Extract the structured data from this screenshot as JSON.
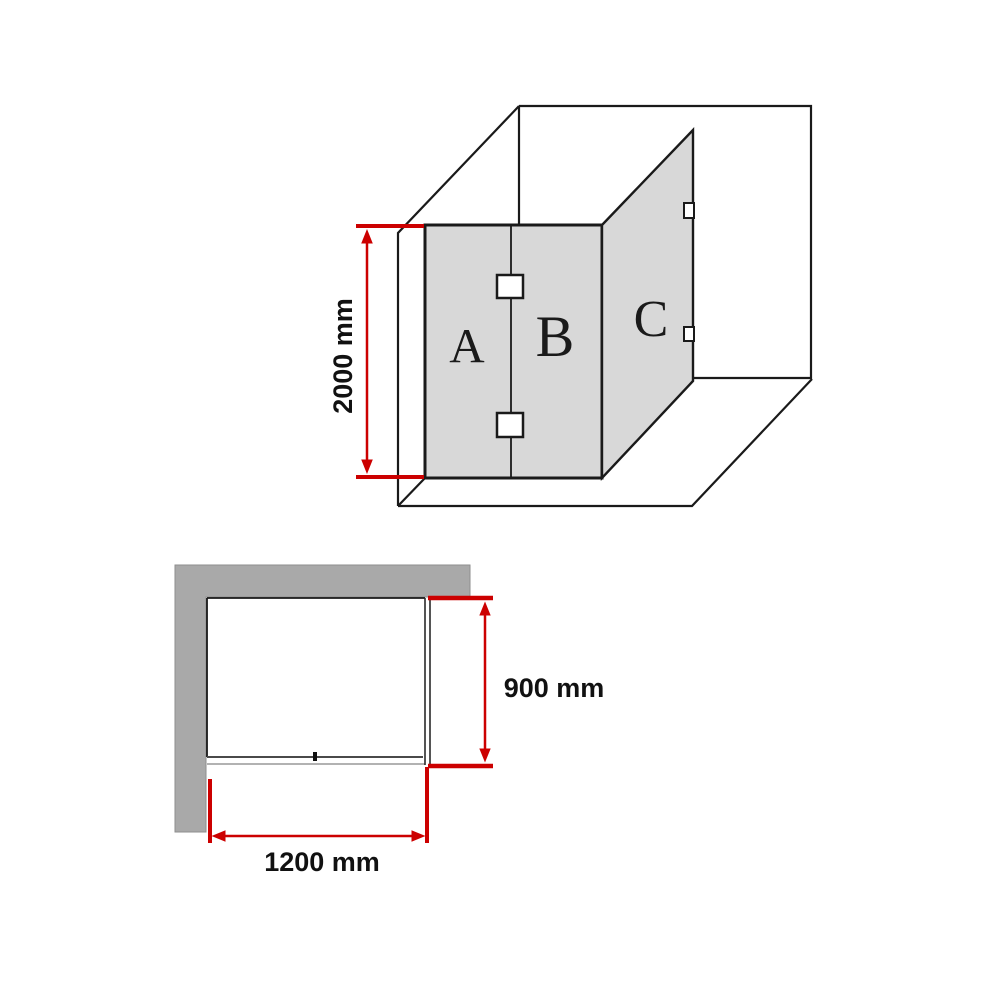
{
  "colors": {
    "dimension_red": "#cc0000",
    "panel_gray": "#d8d8d8",
    "wall_gray": "#a9a9a9",
    "line_black": "#1a1a1a"
  },
  "isometric_view": {
    "panels": [
      {
        "label": "A"
      },
      {
        "label": "B"
      },
      {
        "label": "C"
      }
    ],
    "height_dimension": {
      "label": "2000 mm",
      "value_mm": 2000
    }
  },
  "plan_view": {
    "depth_dimension": {
      "label": "900 mm",
      "value_mm": 900
    },
    "width_dimension": {
      "label": "1200 mm",
      "value_mm": 1200
    }
  }
}
